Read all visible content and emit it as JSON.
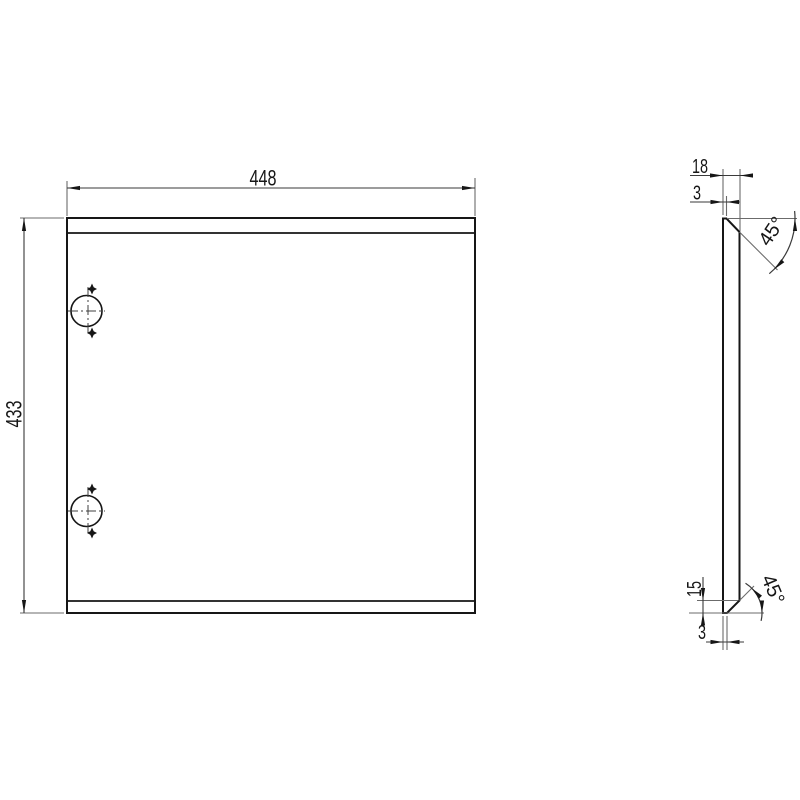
{
  "drawing": {
    "title": "panel-technical-drawing",
    "front_view": {
      "width_dim": "448",
      "height_dim": "433"
    },
    "side_view": {
      "thickness_dim": "18",
      "top_edge_dim": "3",
      "top_chamfer_angle": "45°",
      "bottom_chamfer_height_dim": "15",
      "bottom_edge_dim": "3",
      "bottom_chamfer_angle": "45°"
    },
    "colors": {
      "outline": "#161616",
      "dimension": "#3a3a3a",
      "extension": "#6b6b6b",
      "centerline": "#3f3f3f",
      "text": "#161616"
    }
  }
}
